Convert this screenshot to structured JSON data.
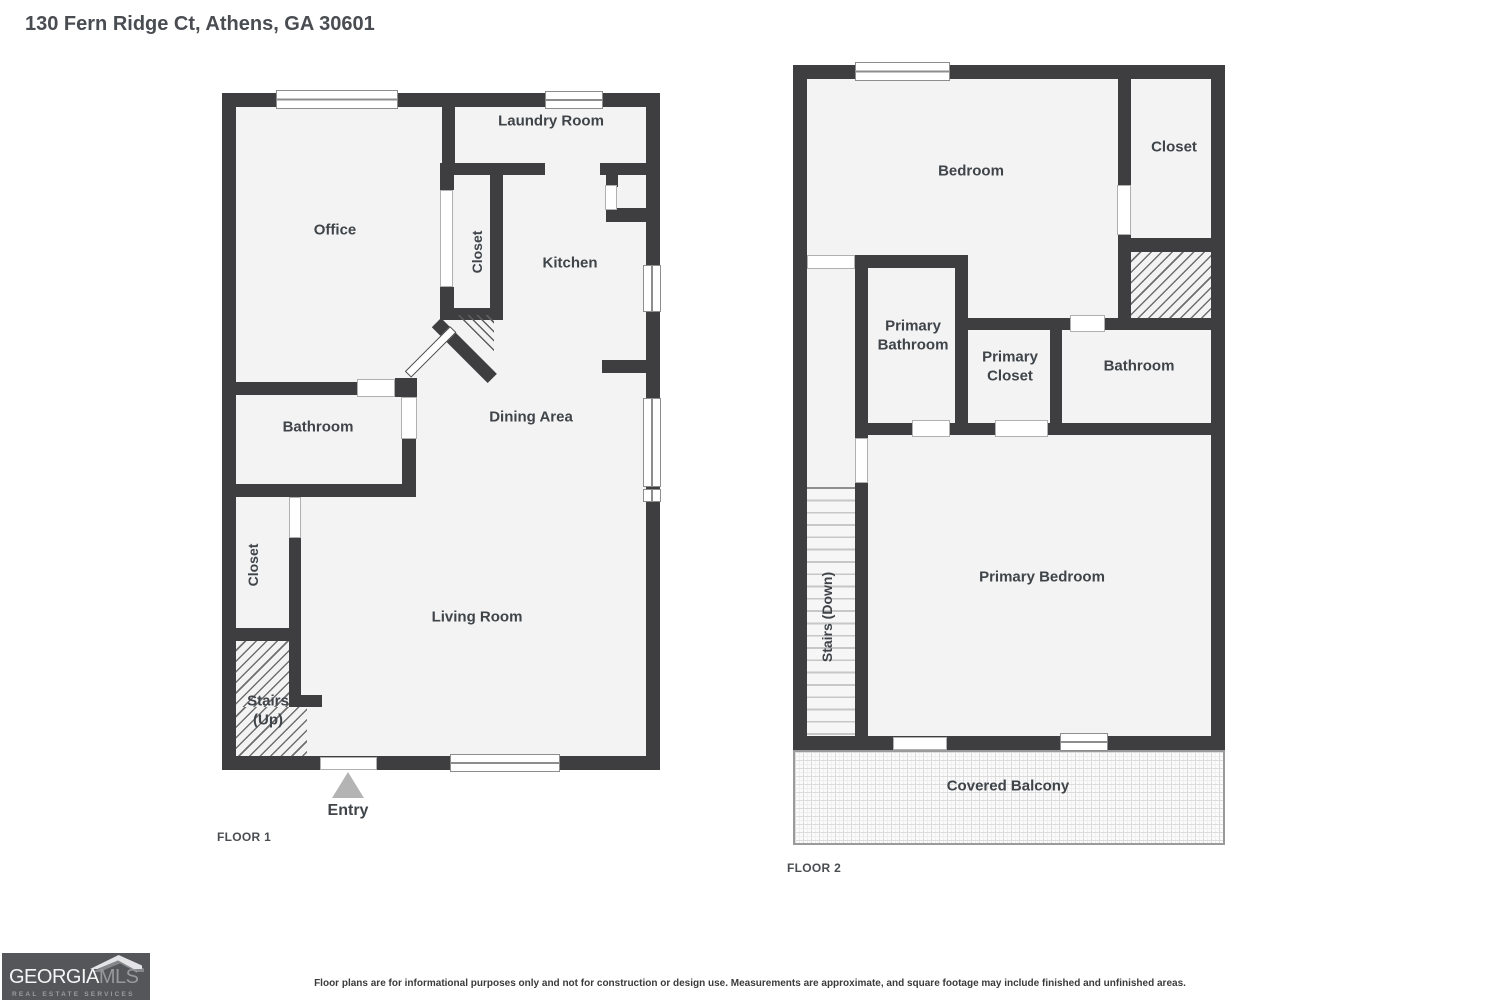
{
  "title": "130 Fern Ridge Ct, Athens, GA 30601",
  "floor1": {
    "tag": "FLOOR 1",
    "rooms": {
      "office": "Office",
      "laundry_room": "Laundry Room",
      "closet_top": "Closet",
      "kitchen": "Kitchen",
      "dining_area": "Dining Area",
      "bathroom": "Bathroom",
      "closet_left": "Closet",
      "living_room": "Living Room",
      "stairs_up": "Stairs (Up)",
      "entry": "Entry"
    }
  },
  "floor2": {
    "tag": "FLOOR 2",
    "rooms": {
      "bedroom": "Bedroom",
      "closet": "Closet",
      "primary_bathroom": "Primary Bathroom",
      "primary_closet": "Primary Closet",
      "bathroom": "Bathroom",
      "stairs_down": "Stairs (Down)",
      "primary_bedroom": "Primary Bedroom",
      "covered_balcony": "Covered Balcony"
    }
  },
  "footer": {
    "disclaimer": "Floor plans are for informational purposes only and not for construction or design use. Measurements are approximate, and square footage may include finished and unfinished areas.",
    "logo": {
      "brand_primary": "GEORGIA",
      "brand_secondary": "MLS",
      "tagline": "REAL ESTATE SERVICES"
    }
  },
  "colors": {
    "wall": "#3e3e40",
    "room_fill": "#f3f3f3",
    "label_text": "#3f4449",
    "logo_background": "#55565a"
  }
}
